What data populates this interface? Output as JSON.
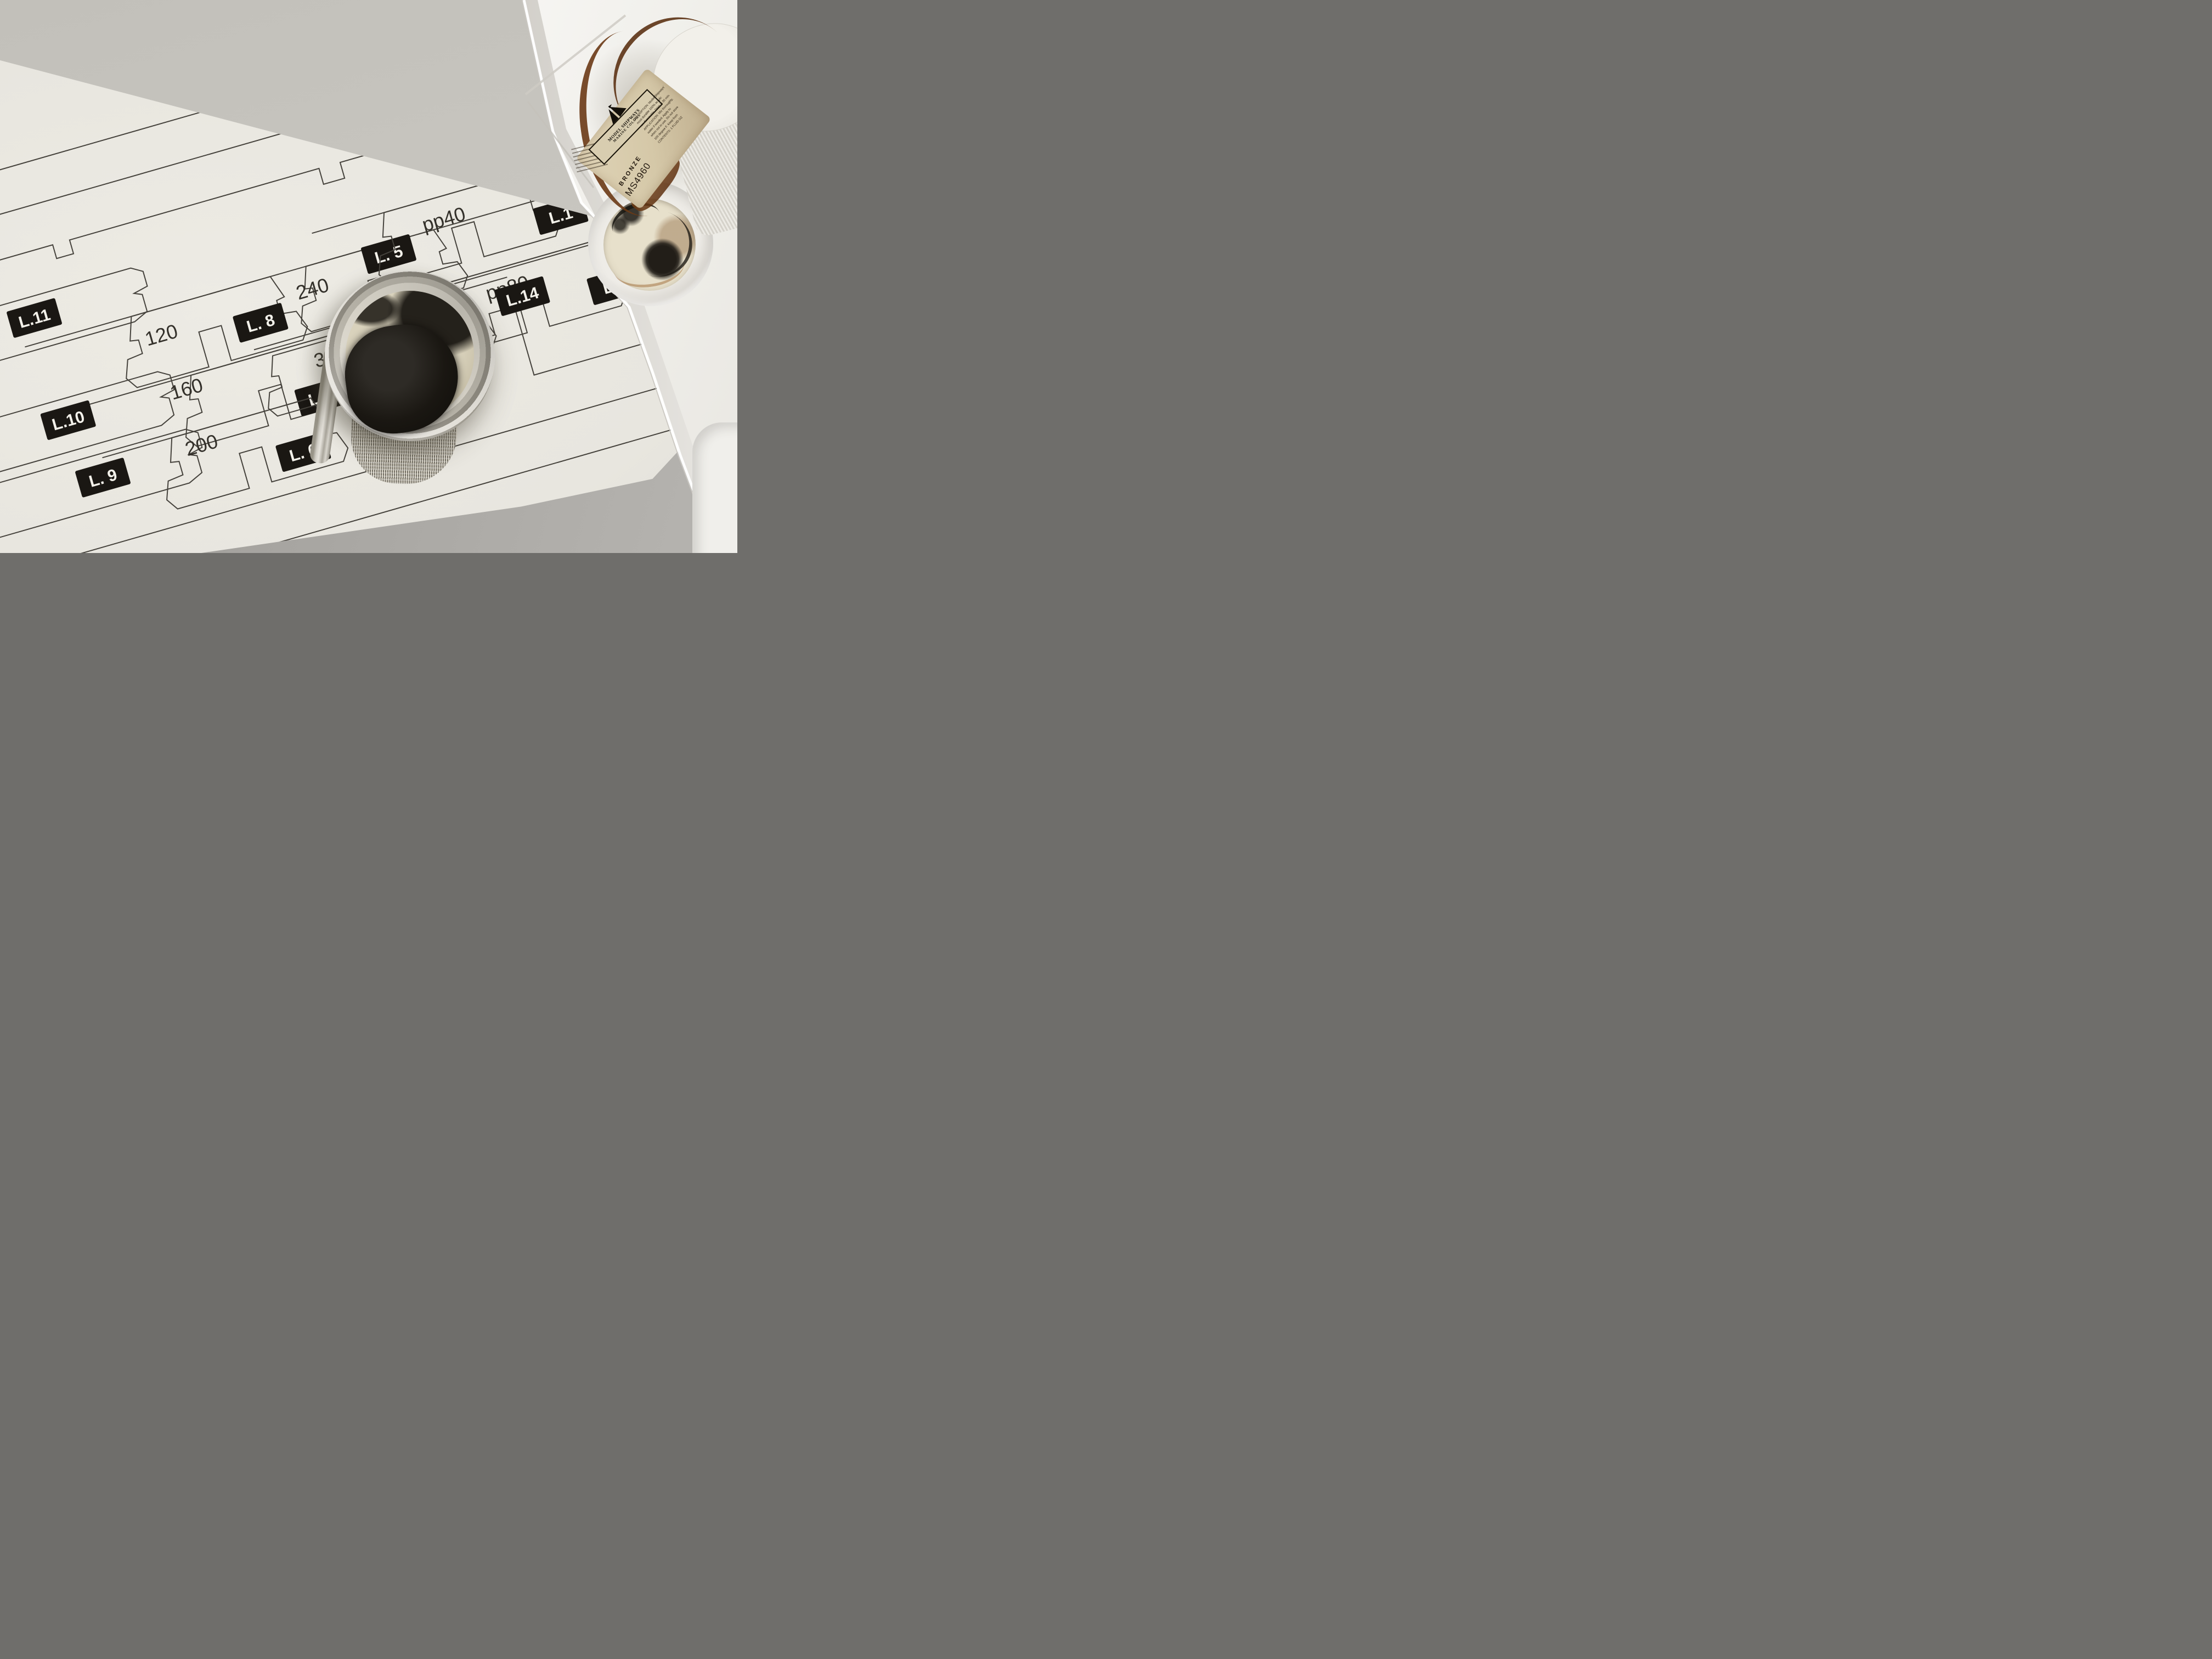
{
  "paper": {
    "badges": {
      "l4": "L. 4",
      "l5": "L. 5",
      "l6": "L. 6",
      "l7": "L. 7",
      "l8": "L. 8",
      "l9": "L. 9",
      "l10": "L.10",
      "l11": "L.11",
      "l14": "L.14",
      "l1a": "L.1",
      "l1b": "L.1"
    },
    "numbers": {
      "n120": "120",
      "n160": "160",
      "n200": "200",
      "n240": "240",
      "n280": "280",
      "n323": "323",
      "pp40": "pp40",
      "pp80": "pp80"
    }
  },
  "bottle": {
    "brand_top": "MODEL SHIPWAYS",
    "brand_bottom": "MARINE COLORS",
    "color_name": "BRONZE",
    "sku": "MS4960",
    "label_lines": [
      "DESCRIPTION: Model Shipways'",
      "most durable 100% acrylic",
      "non flammable. Dries in 30 min.",
      "APPLICATION: Mix thoroughly,",
      "water if needed. Apply to",
      "when not in use. Do not store",
      "100 degree F. Keep from",
      "CONTENTS: 1 FLUID OZ"
    ]
  },
  "colors": {
    "paper": "#e9e7e0",
    "tray_white": "#f2f1ed",
    "table_gray": "#a5a39f",
    "cardboard": "#c7c5bf",
    "template_line": "#45423c",
    "badge_bg": "#1a1713",
    "badge_text": "#f3f1ea",
    "paint_black": "#17130e",
    "bronze": "#6b3a16"
  }
}
